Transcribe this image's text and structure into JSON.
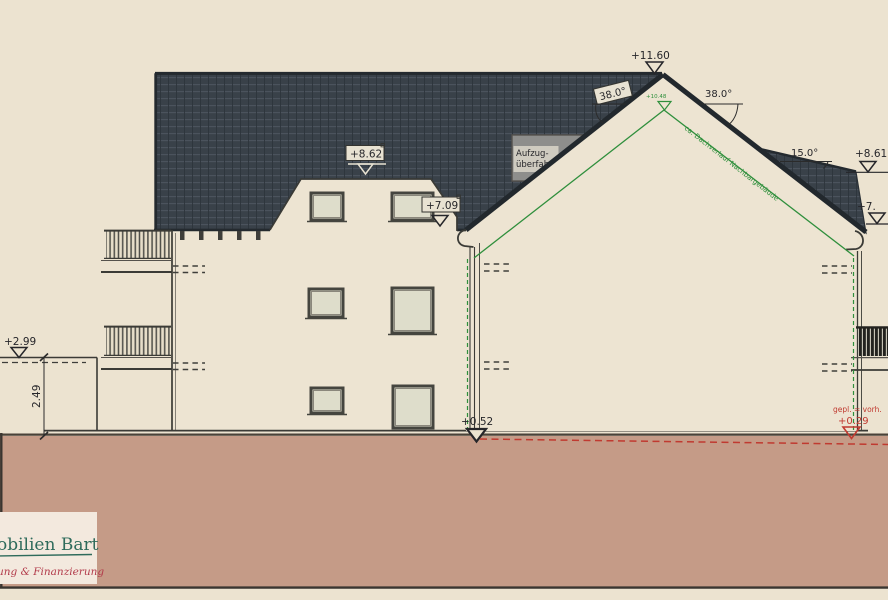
{
  "drawing": {
    "title": "building-elevation",
    "levels": {
      "peak": "+11.60",
      "mansard_top": "+8.62",
      "eaves_left": "+7.09",
      "ridge_right": "+8.61",
      "right_edge_cut": "+7.",
      "terrain_left": "+2.99",
      "base_right": "+0.52",
      "neighbor_ridge": "+10.48",
      "planned_ground": "+0.29"
    },
    "angles": {
      "left_roof": "38.0°",
      "right_roof": "38.0°",
      "low_roof": "15.0°"
    },
    "dimensions": {
      "left_wall_height": "2.49"
    },
    "notes": {
      "elevator_line1": "Aufzug-",
      "elevator_line2": "überfahrt",
      "neighbor_roof": "ca. Dachverlauf Nachbargebäude",
      "ground_note": "gepl. = vorh."
    },
    "logo": {
      "name": "obilien Bart",
      "tagline": "ung & Finanzierung"
    },
    "colors": {
      "sheet": "#ECE3D0",
      "roof": "#394149",
      "ground": "#C59B87",
      "neighbor_green": "#2F8F3C",
      "note_red": "#C03A30",
      "logo_green": "#2E6B5B",
      "logo_red": "#B23A4A",
      "elevator_box": "#8E8E8C"
    }
  }
}
